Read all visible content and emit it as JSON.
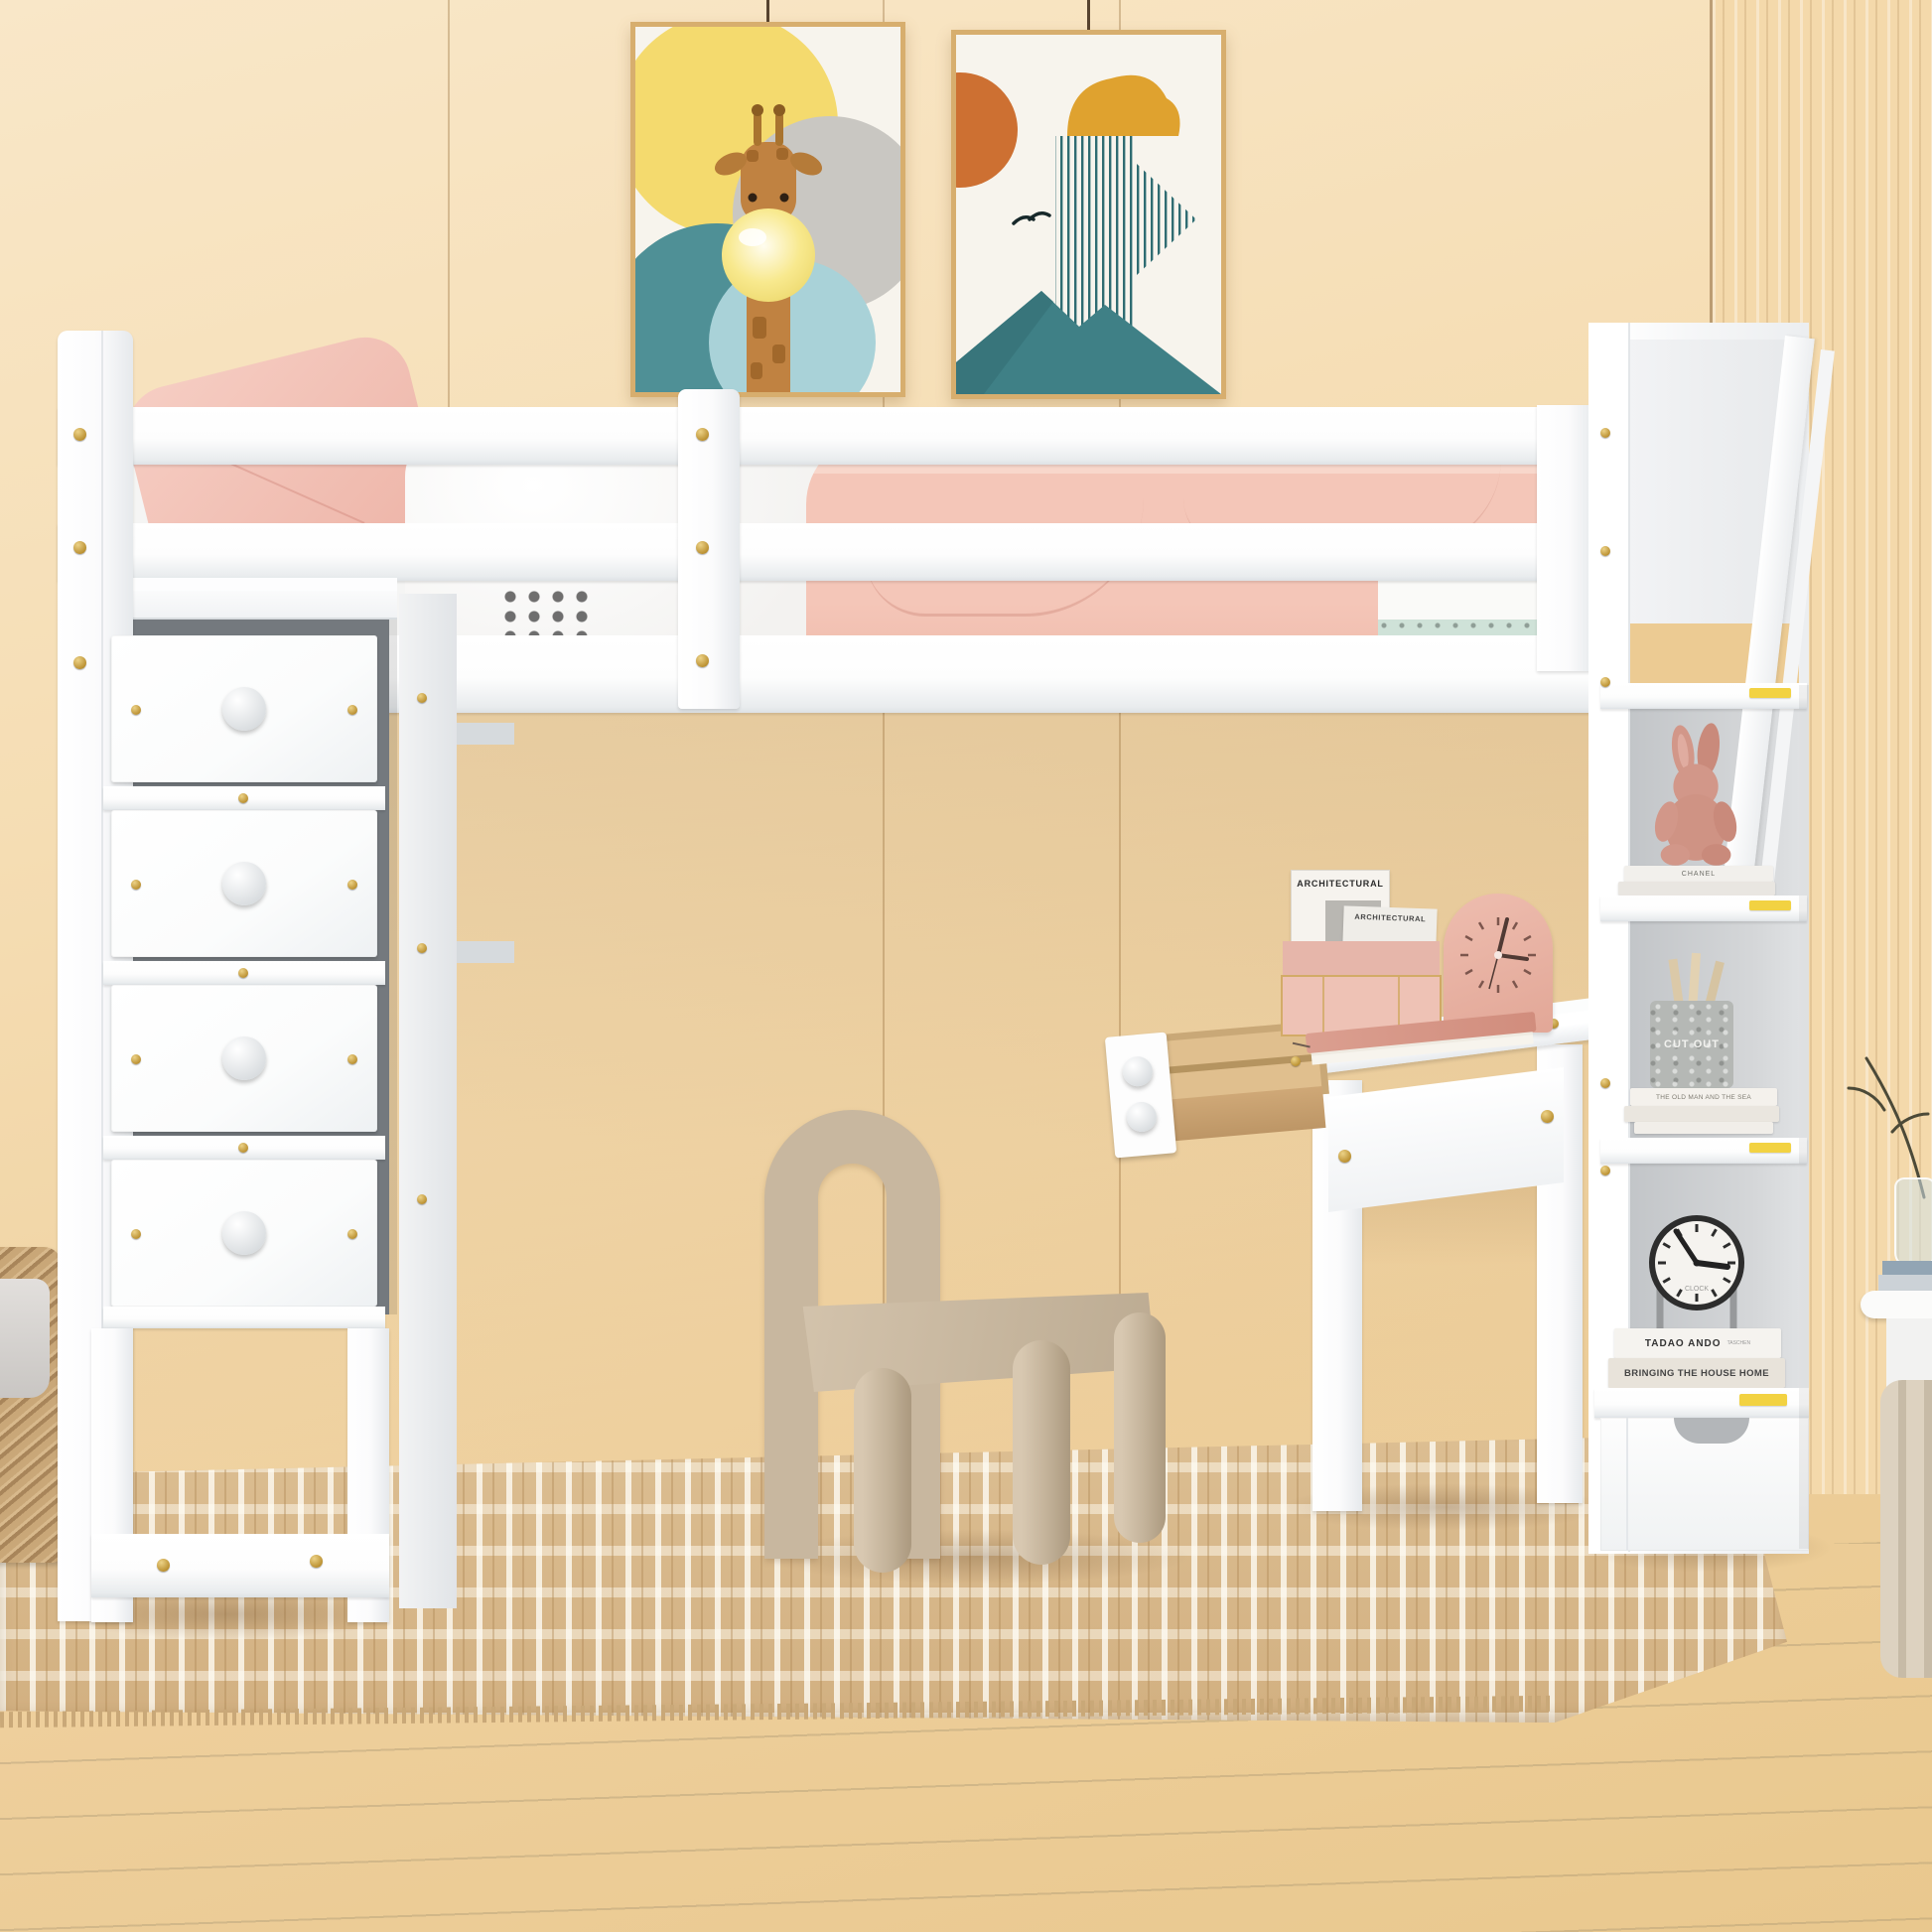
{
  "room": {
    "wall_color": "#f2d7a8",
    "fluted_panel_color": "#f4d9ab",
    "floor_color": "#e0d6c2",
    "rug_colors": [
      "#d8b88a",
      "#efe3cd"
    ],
    "furniture_color": "#ffffff",
    "hardware_color": "#c9a23f"
  },
  "posters": {
    "giraffe": {
      "title": "giraffe-bubblegum-art",
      "frame_color": "#d7ae6e"
    },
    "landscape": {
      "title": "abstract-sun-mountain-art",
      "frame_color": "#d7ae6e"
    }
  },
  "bed": {
    "pillow_color": "#f2c4ba",
    "blanket_color": "#f3c2b3",
    "duvet_color": "#fbfafa",
    "accent_mint": "#cfe2d8"
  },
  "dresser": {
    "drawer_count": 4,
    "knob_color": "#ffffff"
  },
  "chair": {
    "color": "#c8b79f"
  },
  "desk": {
    "magazine_title": "ARCHITECTURAL",
    "magazine_title_2": "ARCHITECTURAL",
    "clock_color": "#e9b3a5",
    "notebook_color": "#d99a8c",
    "drawer_wood_color": "#dcb985"
  },
  "shelf_tower": {
    "compartments": [
      {
        "item": "plush-bunny",
        "book_spine": "CHANEL"
      },
      {
        "item": "pencil-jar",
        "jar_label": "CUT OUT",
        "book_spine": "THE OLD MAN AND THE SEA"
      },
      {
        "item": "table-clock",
        "clock_label": "CLOCK",
        "book_spine_1": "TADAO ANDO",
        "book_spine_1_publisher": "TASCHEN",
        "book_spine_2": "BRINGING THE HOUSE HOME"
      }
    ]
  }
}
